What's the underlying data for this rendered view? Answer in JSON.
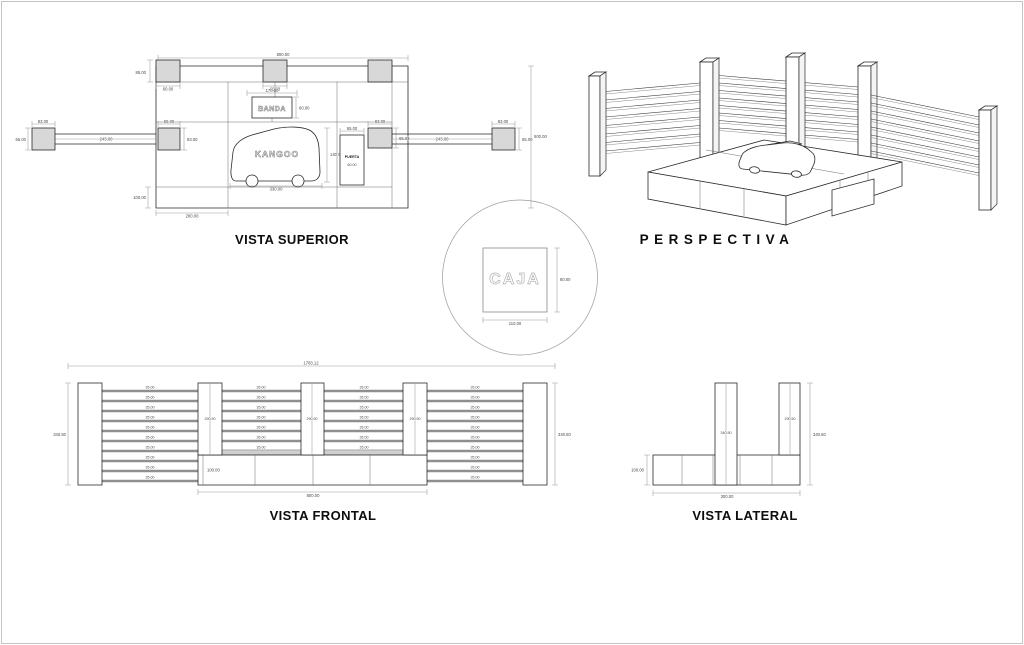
{
  "sheet": {
    "background": "#ffffff",
    "border_color": "#c4c4c4",
    "line_color": "#2a2a2a",
    "dim_color": "#9a9a9a",
    "column_fill": "#d8d8d8"
  },
  "superior": {
    "title": "VISTA SUPERIOR",
    "banda": "BANDA",
    "kangoo": "KANGOO",
    "puerta": "PUERTA",
    "d_total_w": "800.00",
    "d_strip_col_h": "85.00",
    "d_strip_col_w": "60.00",
    "d_center_col_w": "60.00",
    "d_banda_w": "170.00",
    "d_banda_h": "60.00",
    "d_kangoo_l": "330.00",
    "d_kangoo_w": "140.00",
    "d_puerta_w": "65.00",
    "d_puerta_h": "60.00",
    "d_in_left_w": "65.00",
    "d_in_left_h": "83.00",
    "d_in_right_w": "83.00",
    "d_in_right_h": "65.00",
    "d_out_left_w": "83.00",
    "d_out_left_h": "65.00",
    "d_out_right_w": "83.00",
    "d_out_right_h": "65.00",
    "d_left_arm": "243.00",
    "d_right_arm": "243.00",
    "d_depth": "500.00",
    "d_bottom_h": "100.00",
    "d_bottom_w": "200.00"
  },
  "perspectiva": {
    "title": "PERSPECTIVA"
  },
  "caja": {
    "label": "CAJA",
    "d_w": "110.00",
    "d_h": "80.00"
  },
  "frontal": {
    "title": "VISTA FRONTAL",
    "d_total_w": "1783.12",
    "d_height_l": "340.50",
    "d_height_r": "340.50",
    "d_pillar_h": "290.50",
    "d_slat": "35.00",
    "d_plat_h": "100.00",
    "d_plat_w": "800.00"
  },
  "lateral": {
    "title": "VISTA LATERAL",
    "d_plat_w": "300.00",
    "d_plat_h": "100.00",
    "d_tall": "340.50",
    "d_short": "290.50",
    "d_overall": "340.50"
  }
}
